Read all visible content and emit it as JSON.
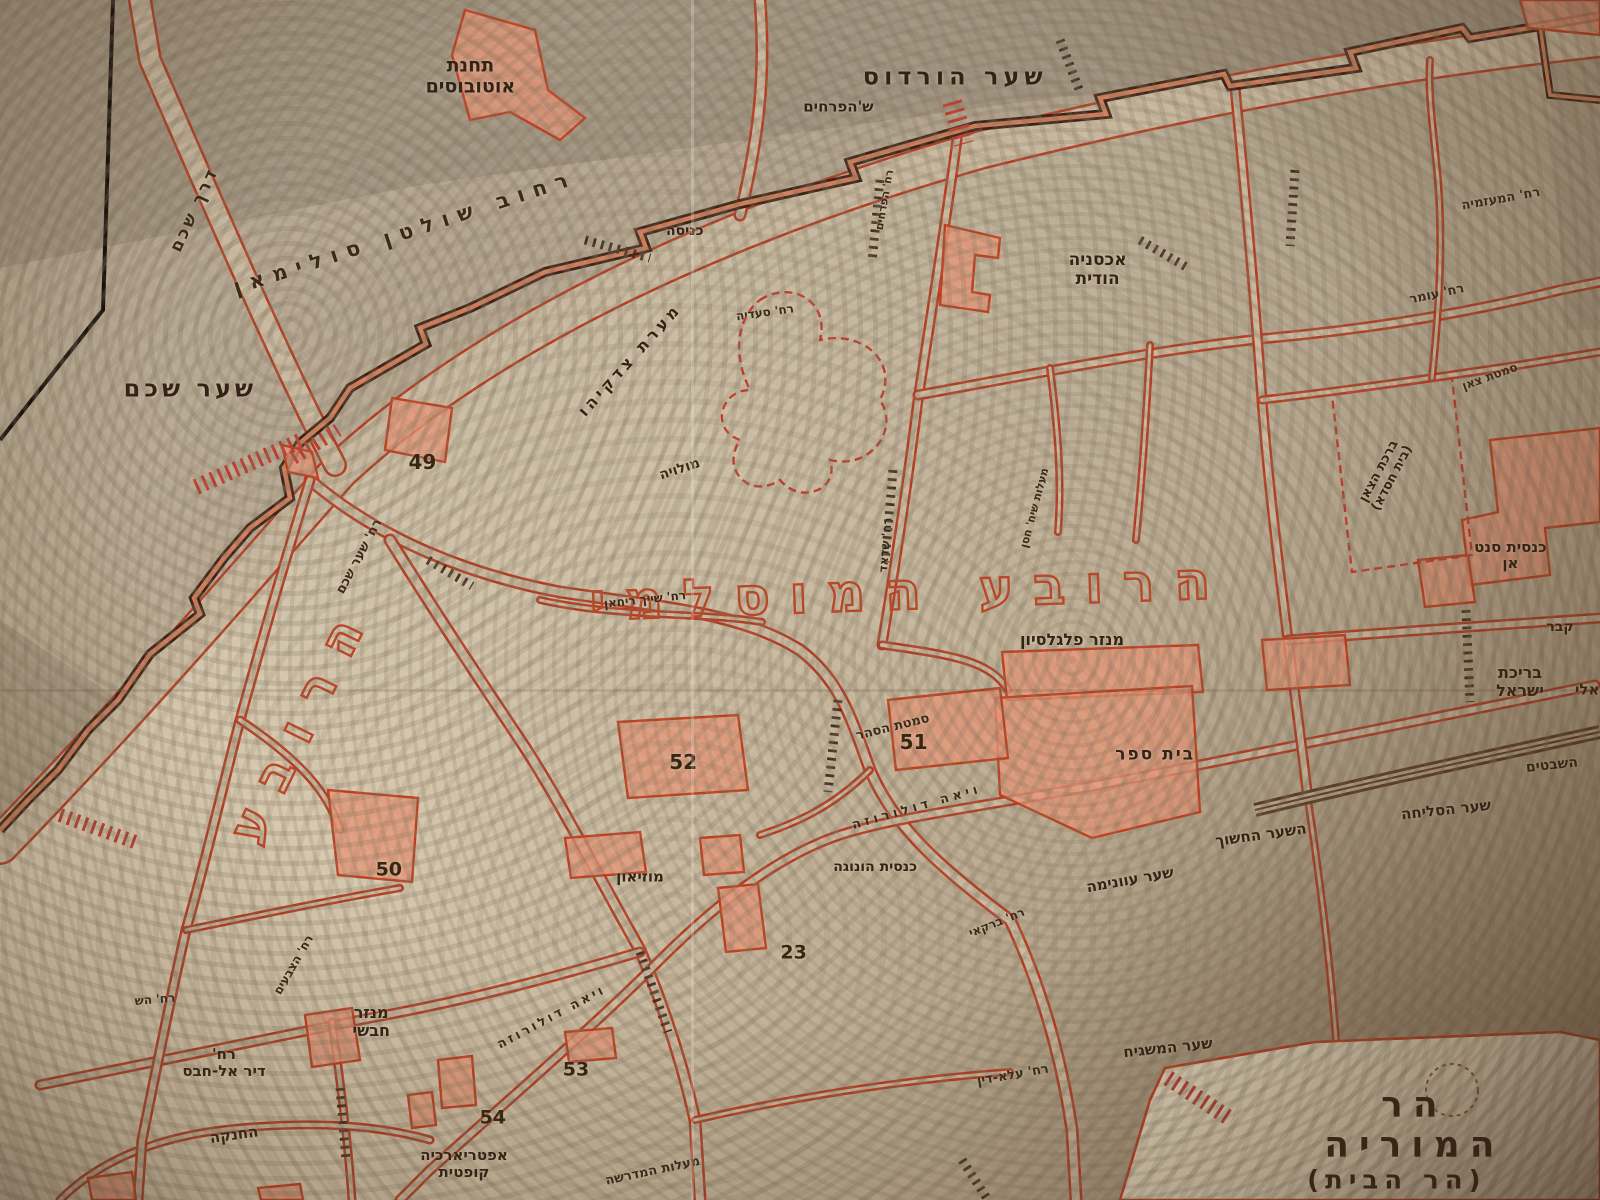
{
  "palette": {
    "paper": "#d6c8ae",
    "photo_shadow": "#8e8170",
    "street": "#b23c22",
    "street_casing": "#c6b69d",
    "wall": "#3c2316",
    "wall_core": "#ce7c5a",
    "building_fill": "#e29273",
    "building_stroke": "#c03d1d",
    "label_ink": "#322316",
    "quarter_outline": "#b8482a"
  },
  "map_title_main": "הרובע המוסלמי",
  "map_title_side": "הרובע",
  "labels": [
    {
      "name": "bus-station",
      "text": "תחנת\nאוטובוסים",
      "x": 29.4,
      "y": 6.4,
      "s": 19,
      "r": 0,
      "c": "place"
    },
    {
      "name": "herods-gate",
      "text": "שער הורדוס",
      "x": 59.7,
      "y": 6.4,
      "s": 24,
      "r": 0,
      "ls": 5,
      "c": "gate"
    },
    {
      "name": "flowers-gate",
      "text": "ש'הפרחים",
      "x": 52.4,
      "y": 8.9,
      "s": 15,
      "r": 0,
      "c": "place"
    },
    {
      "name": "sultan-suleiman-street",
      "text": "רחוב שולטן סולימאן",
      "x": 25.3,
      "y": 19.4,
      "s": 21,
      "r": -18,
      "ls": 9,
      "c": "street"
    },
    {
      "name": "entrance",
      "text": "כניסה",
      "x": 42.8,
      "y": 19.3,
      "s": 14,
      "r": 0,
      "c": "place"
    },
    {
      "name": "nablus-road",
      "text": "דרך שכם",
      "x": 12.2,
      "y": 17.5,
      "s": 17,
      "r": -65,
      "ls": 3,
      "c": "street"
    },
    {
      "name": "damascus-gate",
      "text": "שער שכם",
      "x": 11.9,
      "y": 32.4,
      "s": 24,
      "r": 0,
      "ls": 4,
      "c": "gate"
    },
    {
      "name": "indian-hostel",
      "text": "אכסניה\nהודית",
      "x": 68.6,
      "y": 22.5,
      "s": 17,
      "r": 0,
      "c": "place"
    },
    {
      "name": "muazzamiya-street",
      "text": "רח' המעזמיה",
      "x": 93.8,
      "y": 16.7,
      "s": 13,
      "r": -10,
      "c": "street"
    },
    {
      "name": "omar-street",
      "text": "רח' עומר",
      "x": 89.8,
      "y": 24.6,
      "s": 13,
      "r": -12,
      "c": "street"
    },
    {
      "name": "zedekiah-cave",
      "text": "מערת צדקיהו",
      "x": 39.4,
      "y": 30.0,
      "s": 16,
      "r": -48,
      "ls": 4,
      "c": "place"
    },
    {
      "name": "molawiya-street",
      "text": "מולויה",
      "x": 42.5,
      "y": 39.2,
      "s": 14,
      "r": -18,
      "c": "street"
    },
    {
      "name": "number-49",
      "text": "49",
      "x": 26.4,
      "y": 38.5,
      "s": 20,
      "r": 0,
      "c": "num"
    },
    {
      "name": "shaar-shchem-street",
      "text": "רח' שער שכם",
      "x": 22.5,
      "y": 46.4,
      "s": 13,
      "r": -62,
      "c": "street"
    },
    {
      "name": "muslim-quarter-title",
      "text": "הרובע המוסלמי",
      "x": 56.9,
      "y": 49.3,
      "s": 52,
      "r": -2,
      "ls": 20,
      "c": "outline"
    },
    {
      "name": "quarter-title-vertical",
      "text": "הרובע",
      "x": 18.8,
      "y": 60.0,
      "s": 50,
      "r": -64,
      "ls": 24,
      "c": "outline"
    },
    {
      "name": "sheikh-rihan-street",
      "text": "רח' שייך ריחאן",
      "x": 40.3,
      "y": 50.0,
      "s": 12,
      "r": -6,
      "c": "street"
    },
    {
      "name": "saadia-street",
      "text": "רח' סעדיה",
      "x": 47.8,
      "y": 26.1,
      "s": 12,
      "r": -8,
      "c": "street"
    },
    {
      "name": "shadad-street",
      "text": "רח' שדאד",
      "x": 55.4,
      "y": 45.4,
      "s": 12,
      "r": -85,
      "c": "street"
    },
    {
      "name": "flowers-street",
      "text": "רח' הפרחים",
      "x": 55.3,
      "y": 16.7,
      "s": 11,
      "r": -80,
      "c": "street"
    },
    {
      "name": "maalot-sheikh-hasan",
      "text": "מעלות שיח' חסן",
      "x": 64.7,
      "y": 42.3,
      "s": 11,
      "r": -75,
      "c": "street"
    },
    {
      "name": "flagellation-monastery",
      "text": "מנזר פלגלסיון",
      "x": 67.0,
      "y": 53.3,
      "s": 16,
      "r": 0,
      "c": "place"
    },
    {
      "name": "crescent-alley",
      "text": "סמטת הסהר",
      "x": 55.8,
      "y": 60.7,
      "s": 13,
      "r": -14,
      "c": "street"
    },
    {
      "name": "number-51",
      "text": "51",
      "x": 57.1,
      "y": 61.8,
      "s": 20,
      "r": 0,
      "c": "num"
    },
    {
      "name": "number-52",
      "text": "52",
      "x": 42.7,
      "y": 63.5,
      "s": 20,
      "r": 0,
      "c": "num"
    },
    {
      "name": "school",
      "text": "בית ספר",
      "x": 72.2,
      "y": 62.9,
      "s": 17,
      "r": 0,
      "ls": 2,
      "c": "place"
    },
    {
      "name": "israel-pool",
      "text": "בריכת ישראל",
      "x": 95.0,
      "y": 56.8,
      "s": 16,
      "r": 0,
      "c": "place"
    },
    {
      "name": "eli-partial",
      "text": "אלי",
      "x": 99.2,
      "y": 57.5,
      "s": 15,
      "r": 0,
      "c": "place"
    },
    {
      "name": "tomb-partial",
      "text": "קבר",
      "x": 97.5,
      "y": 52.3,
      "s": 14,
      "r": 0,
      "c": "place"
    },
    {
      "name": "tribes-partial",
      "text": "השבטים",
      "x": 97.0,
      "y": 63.8,
      "s": 14,
      "r": -6,
      "c": "place"
    },
    {
      "name": "selicha-gate",
      "text": "שער הסליחה",
      "x": 90.4,
      "y": 67.5,
      "s": 15,
      "r": -6,
      "c": "place"
    },
    {
      "name": "dark-gate",
      "text": "השער החשוך",
      "x": 78.8,
      "y": 69.6,
      "s": 15,
      "r": -8,
      "c": "place"
    },
    {
      "name": "ghawanima-gate",
      "text": "שער עוונימה",
      "x": 70.6,
      "y": 73.3,
      "s": 15,
      "r": -10,
      "c": "place"
    },
    {
      "name": "museum",
      "text": "מוזיאון",
      "x": 40.0,
      "y": 73.1,
      "s": 15,
      "r": 0,
      "c": "place"
    },
    {
      "name": "honoga-church",
      "text": "כנסית הונוגה",
      "x": 54.7,
      "y": 72.3,
      "s": 14,
      "r": 0,
      "c": "place"
    },
    {
      "name": "number-23",
      "text": "23",
      "x": 49.6,
      "y": 79.4,
      "s": 19,
      "r": 0,
      "c": "num"
    },
    {
      "name": "via-dolorosa-east",
      "text": "ויאה דולורוזה",
      "x": 57.3,
      "y": 67.3,
      "s": 13,
      "r": -16,
      "ls": 4,
      "c": "street"
    },
    {
      "name": "via-dolorosa-west",
      "text": "ויאה דולורוזה",
      "x": 34.5,
      "y": 84.8,
      "s": 13,
      "r": -28,
      "ls": 3,
      "c": "street"
    },
    {
      "name": "barkai-street",
      "text": "רח' ברקאי",
      "x": 62.3,
      "y": 76.9,
      "s": 12,
      "r": -22,
      "c": "street"
    },
    {
      "name": "aladdin-street",
      "text": "רח' עלא-דין",
      "x": 63.3,
      "y": 89.7,
      "s": 13,
      "r": -10,
      "c": "street"
    },
    {
      "name": "mashgiach-gate",
      "text": "שער המשגיח",
      "x": 73.0,
      "y": 87.3,
      "s": 15,
      "r": -6,
      "c": "place"
    },
    {
      "name": "mount-moriah",
      "text": "הר המוריה",
      "x": 88.4,
      "y": 93.8,
      "s": 36,
      "r": 0,
      "ls": 10,
      "c": "gate"
    },
    {
      "name": "temple-mount",
      "text": "(הר הבית)",
      "x": 87.3,
      "y": 98.4,
      "s": 26,
      "r": 0,
      "ls": 6,
      "c": "gate"
    },
    {
      "name": "abyssinian-monastery",
      "text": "מנזר\nחבשי",
      "x": 23.2,
      "y": 85.2,
      "s": 16,
      "r": 0,
      "c": "place"
    },
    {
      "name": "deir-al-habs-street",
      "text": "רח'\nדיר אל-חבס",
      "x": 14.0,
      "y": 88.6,
      "s": 15,
      "r": 0,
      "c": "place"
    },
    {
      "name": "khanqah",
      "text": "החנקה",
      "x": 14.6,
      "y": 94.6,
      "s": 15,
      "r": -8,
      "c": "place"
    },
    {
      "name": "coptic-patriarchate",
      "text": "אפטריארכיה\nקופטית",
      "x": 29.0,
      "y": 97.0,
      "s": 15,
      "r": 0,
      "c": "place"
    },
    {
      "name": "number-54",
      "text": "54",
      "x": 30.8,
      "y": 93.2,
      "s": 19,
      "r": 0,
      "c": "num"
    },
    {
      "name": "number-53",
      "text": "53",
      "x": 36.0,
      "y": 89.2,
      "s": 19,
      "r": 0,
      "c": "num"
    },
    {
      "name": "number-50",
      "text": "50",
      "x": 24.3,
      "y": 72.5,
      "s": 19,
      "r": 0,
      "c": "num"
    },
    {
      "name": "midrasha-steps",
      "text": "מעלות המדרשה",
      "x": 40.8,
      "y": 97.7,
      "s": 13,
      "r": -12,
      "c": "street"
    },
    {
      "name": "tzavaim-street",
      "text": "רח' הצבעים",
      "x": 18.4,
      "y": 80.4,
      "s": 12,
      "r": -60,
      "c": "street"
    },
    {
      "name": "hash-street-partial",
      "text": "רח' הש",
      "x": 9.7,
      "y": 83.3,
      "s": 12,
      "r": -5,
      "c": "street"
    },
    {
      "name": "bethesda-pool",
      "text": "ברכת הצאן\n(בית חסדא)",
      "x": 86.6,
      "y": 39.6,
      "s": 13,
      "r": -62,
      "c": "place"
    },
    {
      "name": "tzaan-alley",
      "text": "סמטת צאן",
      "x": 93.1,
      "y": 31.4,
      "s": 12,
      "r": -20,
      "c": "street"
    },
    {
      "name": "st-anne-church",
      "text": "כנסית סנט אן",
      "x": 94.4,
      "y": 46.3,
      "s": 15,
      "r": 0,
      "c": "place"
    }
  ]
}
